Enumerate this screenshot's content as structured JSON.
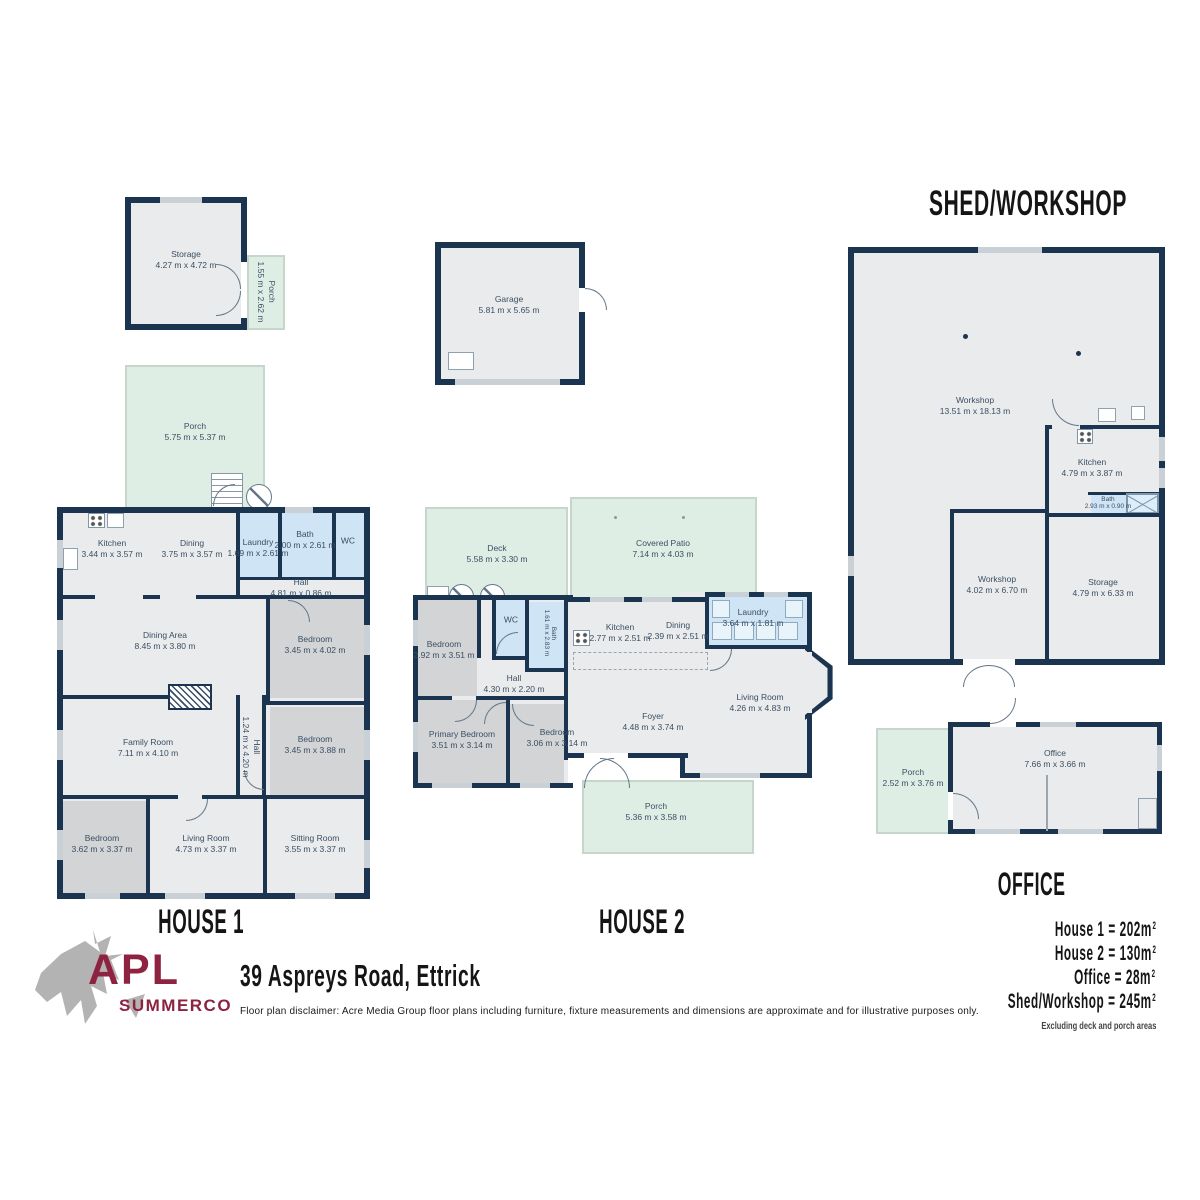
{
  "colors": {
    "wall": "#1b3450",
    "room": "#e9ebec",
    "bedroom": "#d2d4d6",
    "wet": "#cfe4f4",
    "porch": "#dfeee5",
    "brand": "#8d2241",
    "logo_gray": "#b3b3b3"
  },
  "logo": {
    "line1": "APL",
    "line2": "SUMMERCO"
  },
  "address": "39 Aspreys Road, Ettrick",
  "disclaimer": "Floor plan disclaimer: Acre Media Group floor plans including furniture, fixture measurements and dimensions are approximate and for illustrative purposes only.",
  "titles": {
    "shed": "SHED/WORKSHOP",
    "house1": "HOUSE 1",
    "house2": "HOUSE 2",
    "office": "OFFICE"
  },
  "summary": {
    "items": [
      {
        "text": "House 1 = 202m",
        "sup": "2"
      },
      {
        "text": "House 2 = 130m",
        "sup": "2"
      },
      {
        "text": "Office = 28m",
        "sup": "2"
      },
      {
        "text": "Shed/Workshop = 245m",
        "sup": "2"
      }
    ],
    "note": "Excluding deck and porch areas"
  },
  "storage_building": {
    "storage": {
      "name": "Storage",
      "dims": "4.27 m x 4.72 m"
    },
    "porch": {
      "name": "Porch",
      "dims": "1.55 m x 2.62 m"
    }
  },
  "garage_building": {
    "garage": {
      "name": "Garage",
      "dims": "5.81 m x 5.65 m"
    }
  },
  "shed": {
    "workshop_main": {
      "name": "Workshop",
      "dims": "13.51 m x 18.13 m"
    },
    "kitchen": {
      "name": "Kitchen",
      "dims": "4.79 m x 3.87 m"
    },
    "bath": {
      "name": "Bath",
      "dims": "2.93 m x 0.90 m"
    },
    "workshop2": {
      "name": "Workshop",
      "dims": "4.02 m x 6.70 m"
    },
    "storage": {
      "name": "Storage",
      "dims": "4.79 m x 6.33 m"
    }
  },
  "house1": {
    "porch": {
      "name": "Porch",
      "dims": "5.75 m x 5.37 m"
    },
    "kitchen": {
      "name": "Kitchen",
      "dims": "3.44 m x 3.57 m"
    },
    "dining": {
      "name": "Dining",
      "dims": "3.75 m x 3.57 m"
    },
    "laundry": {
      "name": "Laundry",
      "dims": "1.69 m x 2.61 m"
    },
    "bath": {
      "name": "Bath",
      "dims": "2.00 m x 2.61 m"
    },
    "wc": {
      "name": "WC"
    },
    "hall_top": {
      "name": "Hall",
      "dims": "4.81 m x 0.86 m"
    },
    "dining_area": {
      "name": "Dining Area",
      "dims": "8.45 m x 3.80 m"
    },
    "bedroom1": {
      "name": "Bedroom",
      "dims": "3.45 m x 4.02 m"
    },
    "family": {
      "name": "Family Room",
      "dims": "7.11 m x 4.10 m"
    },
    "hall_mid": {
      "name": "Hall",
      "dims": "1.24 m x 4.20 m"
    },
    "bedroom2": {
      "name": "Bedroom",
      "dims": "3.45 m x 3.88 m"
    },
    "bedroom3": {
      "name": "Bedroom",
      "dims": "3.62 m x 3.37 m"
    },
    "living": {
      "name": "Living Room",
      "dims": "4.73 m x 3.37 m"
    },
    "sitting": {
      "name": "Sitting Room",
      "dims": "3.55 m x 3.37 m"
    }
  },
  "house2": {
    "deck": {
      "name": "Deck",
      "dims": "5.58 m x 3.30 m"
    },
    "patio": {
      "name": "Covered Patio",
      "dims": "7.14 m x 4.03 m"
    },
    "bedroom1": {
      "name": "Bedroom",
      "dims": "2.92 m x 3.51 m"
    },
    "wc": {
      "name": "WC"
    },
    "bath": {
      "name": "Bath",
      "dims": "1.61 m x 2.83 m"
    },
    "kitchen": {
      "name": "Kitchen",
      "dims": "2.77 m x 2.51 m"
    },
    "dining": {
      "name": "Dining",
      "dims": "2.39 m x 2.51 m"
    },
    "laundry": {
      "name": "Laundry",
      "dims": "3.64 m x 1.81 m"
    },
    "hall": {
      "name": "Hall",
      "dims": "4.30 m x 2.20 m"
    },
    "primary": {
      "name": "Primary Bedroom",
      "dims": "3.51 m x 3.14 m"
    },
    "bedroom2": {
      "name": "Bedroom",
      "dims": "3.06 m x 3.14 m"
    },
    "foyer": {
      "name": "Foyer",
      "dims": "4.48 m x 3.74 m"
    },
    "living": {
      "name": "Living Room",
      "dims": "4.26 m x 4.83 m"
    },
    "porch": {
      "name": "Porch",
      "dims": "5.36 m x 3.58 m"
    }
  },
  "office": {
    "porch": {
      "name": "Porch",
      "dims": "2.52 m x 3.76 m"
    },
    "office": {
      "name": "Office",
      "dims": "7.66 m x 3.66 m"
    }
  }
}
